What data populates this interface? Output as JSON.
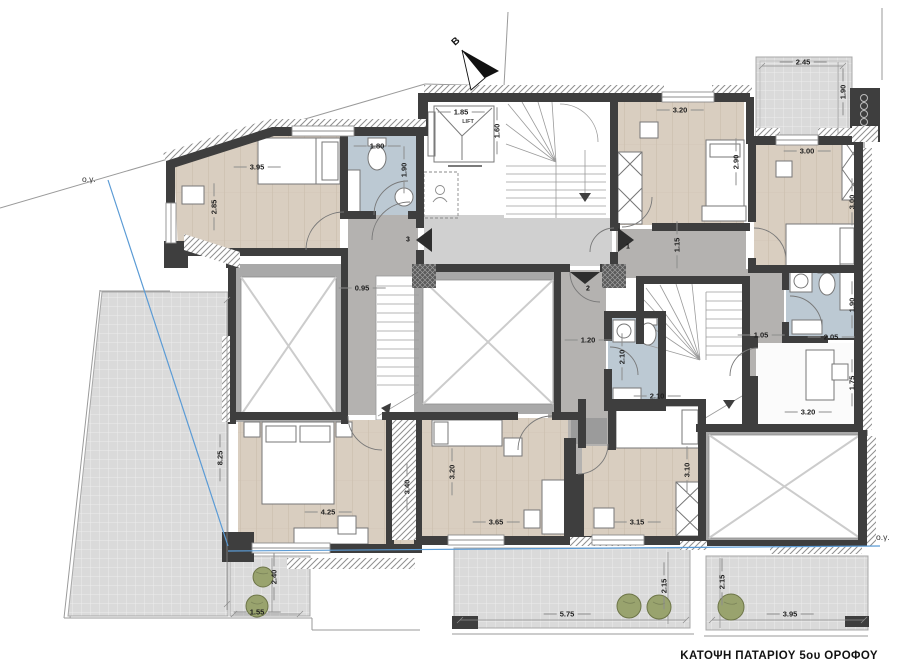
{
  "title": "ΚΑΤΟΨΗ ΠΑΤΑΡΙΟΥ 5ου ΟΡΟΦΟΥ",
  "north_arrow": {
    "label": "Β"
  },
  "lift": {
    "label": "LIFT",
    "width": "1.85",
    "depth": "1.60"
  },
  "building_lines": {
    "left": "ο.γ.",
    "right": "ο.γ.",
    "color": "#5b9bd5"
  },
  "entrance_numbers": [
    {
      "text": "1",
      "x": 628,
      "y": 247
    },
    {
      "text": "2",
      "x": 588,
      "y": 289
    },
    {
      "text": "3",
      "x": 408,
      "y": 240
    }
  ],
  "dimensions": [
    {
      "text": "3.95",
      "x": 257,
      "y": 167,
      "rot": false
    },
    {
      "text": "2.85",
      "x": 214,
      "y": 207,
      "rot": true
    },
    {
      "text": "1.80",
      "x": 377,
      "y": 146,
      "rot": false
    },
    {
      "text": "1.90",
      "x": 404,
      "y": 170,
      "rot": true
    },
    {
      "text": "1.85",
      "x": 461,
      "y": 112,
      "rot": false
    },
    {
      "text": "1.60",
      "x": 497,
      "y": 131,
      "rot": true
    },
    {
      "text": "3.20",
      "x": 680,
      "y": 110,
      "rot": false
    },
    {
      "text": "2.90",
      "x": 736,
      "y": 162,
      "rot": true
    },
    {
      "text": "2.45",
      "x": 803,
      "y": 62,
      "rot": false
    },
    {
      "text": "1.90",
      "x": 843,
      "y": 92,
      "rot": true
    },
    {
      "text": "3.00",
      "x": 807,
      "y": 151,
      "rot": false
    },
    {
      "text": "3.00",
      "x": 852,
      "y": 202,
      "rot": true
    },
    {
      "text": "1.15",
      "x": 677,
      "y": 245,
      "rot": true
    },
    {
      "text": "0.95",
      "x": 362,
      "y": 288,
      "rot": false
    },
    {
      "text": "1.20",
      "x": 588,
      "y": 340,
      "rot": false
    },
    {
      "text": "1.05",
      "x": 761,
      "y": 335,
      "rot": false
    },
    {
      "text": "1.90",
      "x": 852,
      "y": 305,
      "rot": true
    },
    {
      "text": "2.05",
      "x": 831,
      "y": 337,
      "rot": false
    },
    {
      "text": "2.10",
      "x": 622,
      "y": 357,
      "rot": true
    },
    {
      "text": "2.10",
      "x": 657,
      "y": 396,
      "rot": false
    },
    {
      "text": "1.75",
      "x": 852,
      "y": 383,
      "rot": true
    },
    {
      "text": "3.20",
      "x": 808,
      "y": 412,
      "rot": false
    },
    {
      "text": "8.25",
      "x": 220,
      "y": 458,
      "rot": true
    },
    {
      "text": "4.25",
      "x": 328,
      "y": 512,
      "rot": false
    },
    {
      "text": "3.40",
      "x": 407,
      "y": 487,
      "rot": true
    },
    {
      "text": "3.20",
      "x": 452,
      "y": 472,
      "rot": true
    },
    {
      "text": "3.65",
      "x": 496,
      "y": 522,
      "rot": false
    },
    {
      "text": "3.15",
      "x": 637,
      "y": 522,
      "rot": false
    },
    {
      "text": "3.10",
      "x": 687,
      "y": 470,
      "rot": true
    },
    {
      "text": "2.40",
      "x": 274,
      "y": 577,
      "rot": true
    },
    {
      "text": "1.55",
      "x": 257,
      "y": 612,
      "rot": false
    },
    {
      "text": "5.75",
      "x": 567,
      "y": 614,
      "rot": false
    },
    {
      "text": "2.15",
      "x": 664,
      "y": 586,
      "rot": true
    },
    {
      "text": "2.15",
      "x": 722,
      "y": 582,
      "rot": true
    },
    {
      "text": "3.95",
      "x": 790,
      "y": 614,
      "rot": false
    }
  ],
  "colors": {
    "wall": "#3e3e3e",
    "wood_floor": "#d9cec0",
    "bathroom_floor": "#bcc9d3",
    "corridor_floor": "#b4b2b0",
    "lobby_floor": "#d0d0d0",
    "terrace": "#dcdcdc",
    "void_band": "#a9a9a9",
    "blue_line": "#5b9bd5",
    "tree": "#99a36e"
  }
}
